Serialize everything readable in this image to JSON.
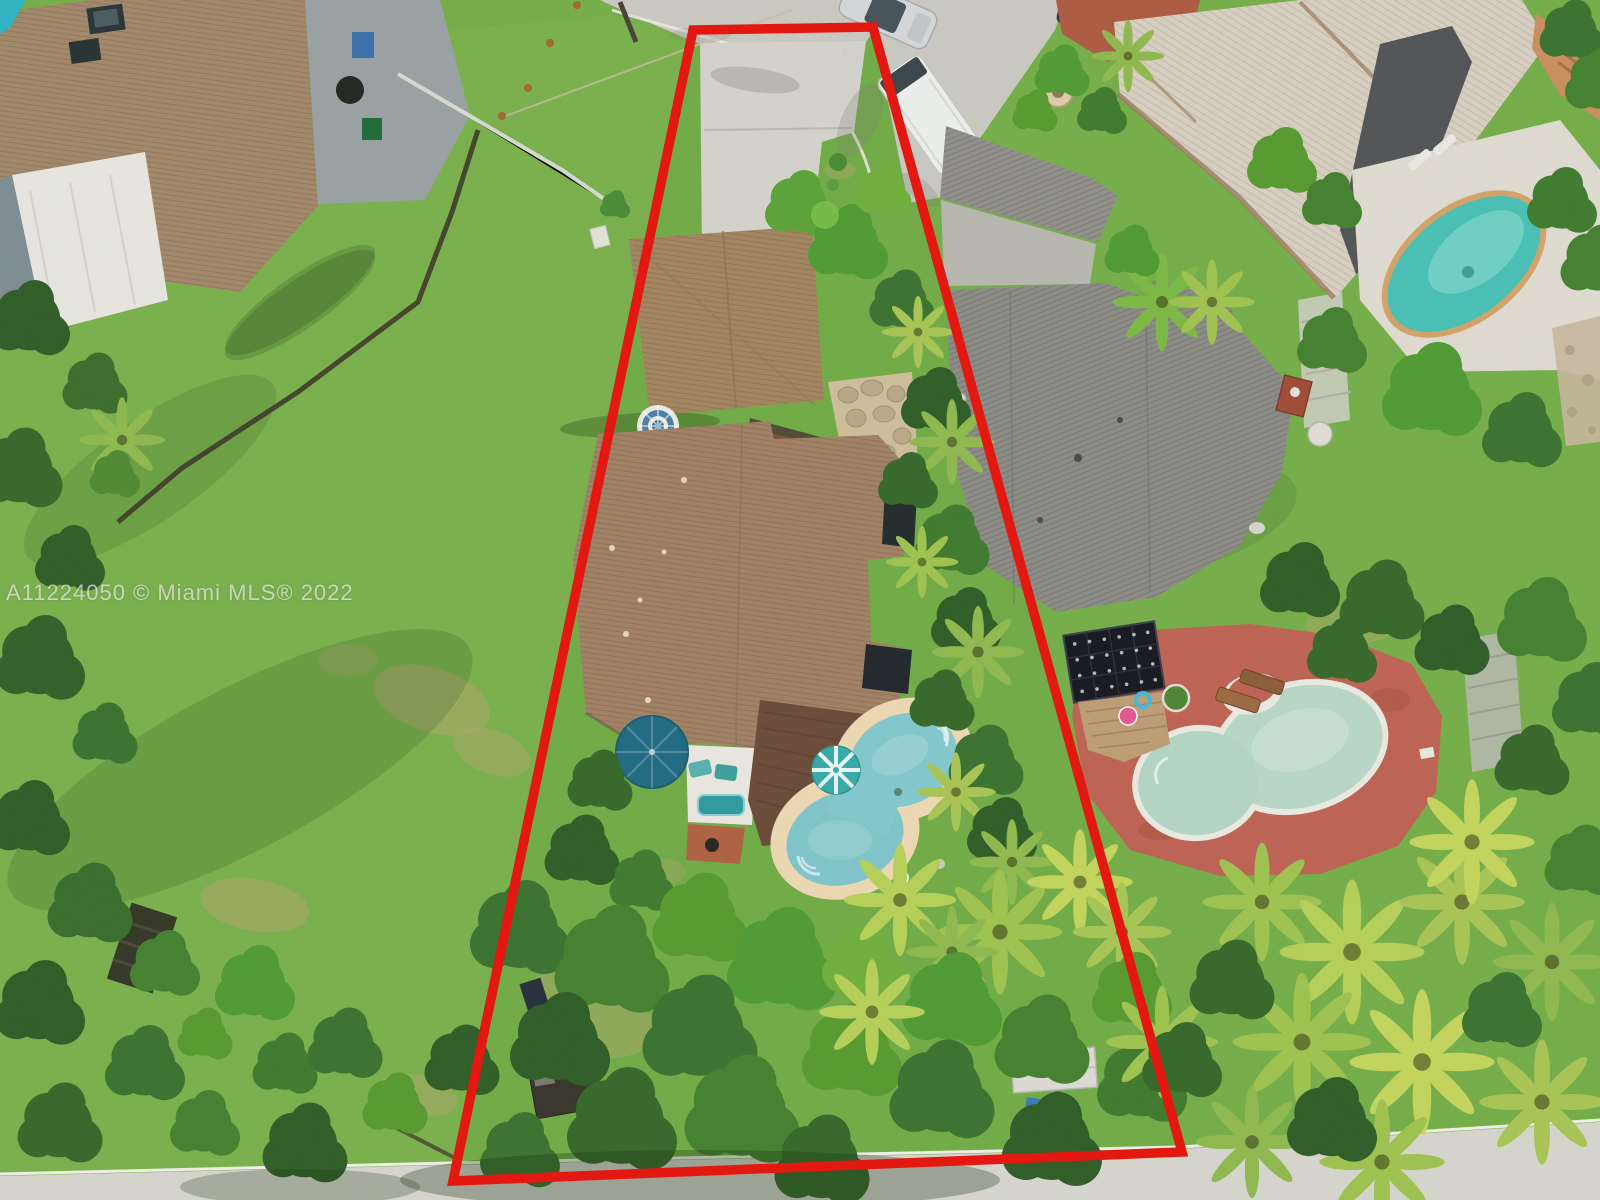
{
  "image": {
    "width": 1600,
    "height": 1200,
    "kind": "aerial-drone-photo",
    "subject": "residential lot outlined in red"
  },
  "watermark": {
    "text": "A11224050 © Miami MLS® 2022"
  },
  "boundary": {
    "points": "693,30 873,27 1182,1152 453,1181",
    "color": "#e31811",
    "stroke_width": 9.5
  },
  "palette": {
    "boundary_red": "#e31811",
    "lawn_green": "#74ad49",
    "tree_dark_green": "#2e5c26",
    "palm_yellow_green": "#b6cf58",
    "roof_brown_subject": "#a08065",
    "roof_brown_topleft": "#a1876a",
    "roof_gray_neighbor": "#8b8a85",
    "roof_beige_topright": "#d7cfc2",
    "concrete": "#c9c8c1",
    "subject_pool_teal": "#82c7cd",
    "neighbor_pool_pale_green": "#b7d7c6",
    "neighbor_pool_turquoise": "#48bfb5",
    "deck_terracotta": "#bd6253",
    "pool_deck_tan": "#ecd8b2",
    "solar_panel_dark": "#171820"
  },
  "features": {
    "subject_lot": "trapezoidal lot outlined in red, driveway to cul-de-sac at top",
    "subject_house": "brown shingle roof house with rear wood deck",
    "detached_garage": "brown roof garage beside driveway",
    "subject_pool": "figure-eight pool with tan deck and two patio umbrellas",
    "vacant_lot_left": "large open grass lot with perimeter trees",
    "street_top": "cul-de-sac street",
    "street_bottom": "street along bottom edge under tree canopy",
    "neighbor_house_right": "gray shingle roof house with carport",
    "neighbor_pool_right": "kidney pool with terracotta deck and solar array",
    "neighbor_house_top_right": "light beige shingle roof house",
    "neighbor_pool_top_right": "turquoise pool with white deck",
    "vehicles": [
      "silver car on street",
      "white van in neighbor driveway",
      "dark blue car on brick pad"
    ]
  }
}
